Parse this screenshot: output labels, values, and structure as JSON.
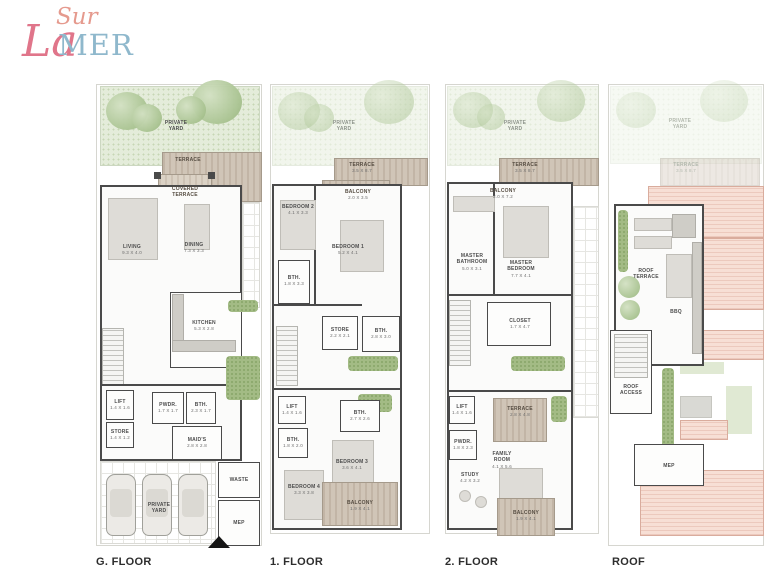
{
  "logo": {
    "sur": "Sur",
    "la": "La",
    "mer": "MER",
    "coral": "#e0758a",
    "blue": "#8fb8cc"
  },
  "colors": {
    "wall": "#4a4a4a",
    "yard_green": "#e4ecda",
    "wood": "#c9bcae",
    "roof_pink": "#f2d7cc",
    "hedge": "#a3bb85"
  },
  "floors": [
    {
      "label": "G. FLOOR",
      "rooms": {
        "yard": {
          "name": "PRIVATE\nYARD"
        },
        "terrace": {
          "name": "TERRACE"
        },
        "covered_terrace": {
          "name": "COVERED\nTERRACE"
        },
        "living": {
          "name": "LIVING",
          "dims": "9.3 X 4.0"
        },
        "dining": {
          "name": "DINING",
          "dims": "7.3 X 3.3"
        },
        "kitchen": {
          "name": "KITCHEN",
          "dims": "5.3 X 2.8"
        },
        "lift": {
          "name": "LIFT",
          "dims": "1.4 X 1.6"
        },
        "store": {
          "name": "STORE",
          "dims": "1.4 X 1.2"
        },
        "pwdr": {
          "name": "PWDR.",
          "dims": "1.7 X 1.7"
        },
        "bth": {
          "name": "BTH.",
          "dims": "2.3 X 1.7"
        },
        "maids": {
          "name": "MAID'S",
          "dims": "2.8 X 2.8"
        },
        "yard2": {
          "name": "PRIVATE\nYARD"
        },
        "waste": {
          "name": "WASTE"
        },
        "mep": {
          "name": "MEP"
        }
      }
    },
    {
      "label": "1. FLOOR",
      "rooms": {
        "yard": {
          "name": "PRIVATE\nYARD"
        },
        "terrace": {
          "name": "TERRACE",
          "dims": "3.5 X 8.7"
        },
        "balcony_top": {
          "name": "BALCONY",
          "dims": "2.0 X 3.5"
        },
        "bedroom2": {
          "name": "BEDROOM 2",
          "dims": "4.1 X 3.3"
        },
        "bedroom1": {
          "name": "BEDROOM 1",
          "dims": "5.2 X 4.1"
        },
        "bth1": {
          "name": "BTH.",
          "dims": "1.8 X 3.3"
        },
        "store": {
          "name": "STORE",
          "dims": "2.2 X 2.1"
        },
        "bth2": {
          "name": "BTH.",
          "dims": "2.8 X 3.0"
        },
        "lift": {
          "name": "LIFT",
          "dims": "1.4 X 1.6"
        },
        "bth3": {
          "name": "BTH.",
          "dims": "2.7 X 2.6"
        },
        "bth4": {
          "name": "BTH.",
          "dims": "1.8 X 2.0"
        },
        "bedroom3": {
          "name": "BEDROOM 3",
          "dims": "3.6 X 4.1"
        },
        "bedroom4": {
          "name": "BEDROOM 4",
          "dims": "3.3 X 3.8"
        },
        "balcony_bottom": {
          "name": "BALCONY",
          "dims": "1.9 X 4.1"
        }
      }
    },
    {
      "label": "2. FLOOR",
      "rooms": {
        "yard": {
          "name": "PRIVATE\nYARD"
        },
        "terrace_top": {
          "name": "TERRACE",
          "dims": "3.5 X 8.7"
        },
        "balcony_top": {
          "name": "BALCONY",
          "dims": "2.0 X 7.2"
        },
        "master_bathroom": {
          "name": "MASTER\nBATHROOM",
          "dims": "5.0 X 3.1"
        },
        "master_bedroom": {
          "name": "MASTER\nBEDROOM",
          "dims": "7.7 X 4.1"
        },
        "closet": {
          "name": "CLOSET",
          "dims": "1.7 X 4.7"
        },
        "lift": {
          "name": "LIFT",
          "dims": "1.4 X 1.6"
        },
        "terrace_mid": {
          "name": "TERRACE",
          "dims": "2.8 X 4.8"
        },
        "pwdr": {
          "name": "PWDR.",
          "dims": "1.8 X 2.3"
        },
        "family_room": {
          "name": "FAMILY\nROOM",
          "dims": "4.1 X 5.6"
        },
        "study": {
          "name": "STUDY",
          "dims": "4.2 X 3.2"
        },
        "balcony_bottom": {
          "name": "BALCONY",
          "dims": "1.9 X 4.1"
        }
      }
    },
    {
      "label": "ROOF",
      "rooms": {
        "yard": {
          "name": "PRIVATE\nYARD"
        },
        "terrace": {
          "name": "TERRACE",
          "dims": "3.5 X 8.7"
        },
        "roof_terrace": {
          "name": "ROOF\nTERRACE"
        },
        "bbq": {
          "name": "BBQ"
        },
        "roof_access": {
          "name": "ROOF\nACCESS"
        },
        "mep": {
          "name": "MEP"
        }
      }
    }
  ]
}
